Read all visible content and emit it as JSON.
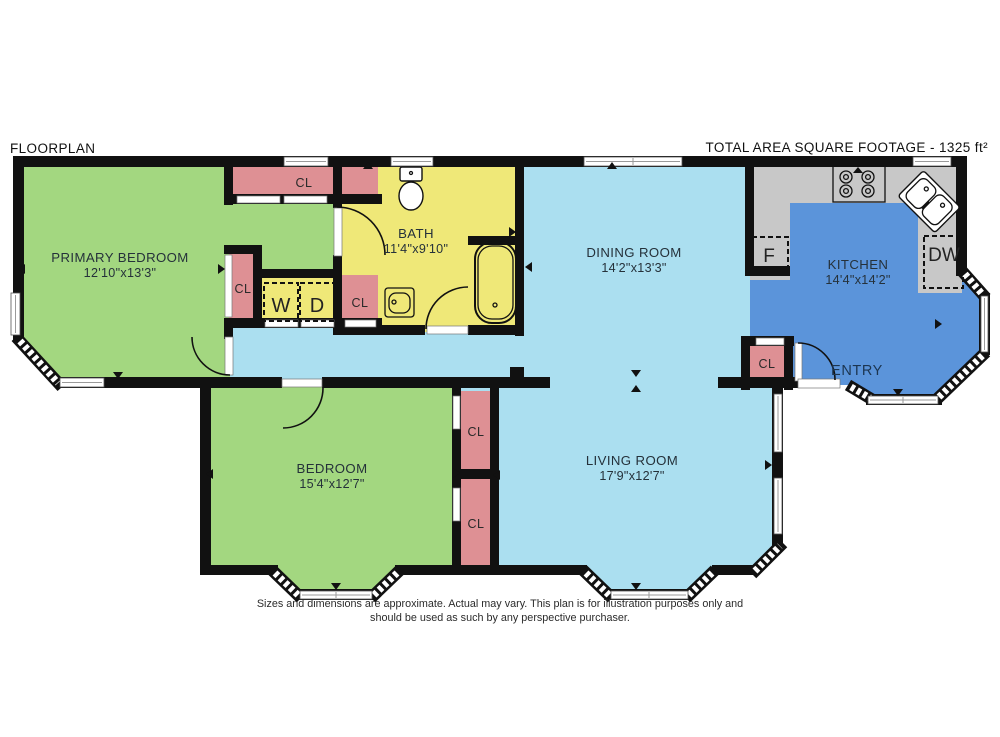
{
  "header": {
    "title": "FLOORPLAN",
    "total_area": "TOTAL AREA SQUARE FOOTAGE - 1325 ft²"
  },
  "rooms": {
    "primary_bedroom": {
      "name": "PRIMARY BEDROOM",
      "dims": "12'10\"x13'3\""
    },
    "bath": {
      "name": "BATH",
      "dims": "11'4\"x9'10\""
    },
    "dining_room": {
      "name": "DINING ROOM",
      "dims": "14'2\"x13'3\""
    },
    "kitchen": {
      "name": "KITCHEN",
      "dims": "14'4\"x14'2\""
    },
    "bedroom": {
      "name": "BEDROOM",
      "dims": "15'4\"x12'7\""
    },
    "living_room": {
      "name": "LIVING ROOM",
      "dims": "17'9\"x12'7\""
    },
    "entry": {
      "name": "ENTRY"
    }
  },
  "labels": {
    "closet": "CL",
    "washer": "W",
    "dryer": "D",
    "fridge": "F",
    "dishwasher": "DW"
  },
  "disclaimer": {
    "line1": "Sizes and dimensions are approximate. Actual may vary. This plan is for illustration purposes only and",
    "line2": "should be used as such by any perspective purchaser."
  },
  "colors": {
    "bedroom_green": "#a3d780",
    "living_cyan": "#abdff0",
    "kitchen_blue": "#5b94da",
    "bath_yellow": "#efe878",
    "closet_pink": "#de9094",
    "counter_gray": "#c8c8c8",
    "wall_black": "#111111"
  },
  "icons": [
    "toilet-icon",
    "bathtub-icon",
    "bathroom-sink-icon",
    "kitchen-sink-icon",
    "stove-icon",
    "washer-box",
    "dryer-box",
    "fridge-box",
    "dishwasher-box",
    "door-arc",
    "window-strip",
    "bay-window-hatch",
    "orientation-arrow"
  ]
}
